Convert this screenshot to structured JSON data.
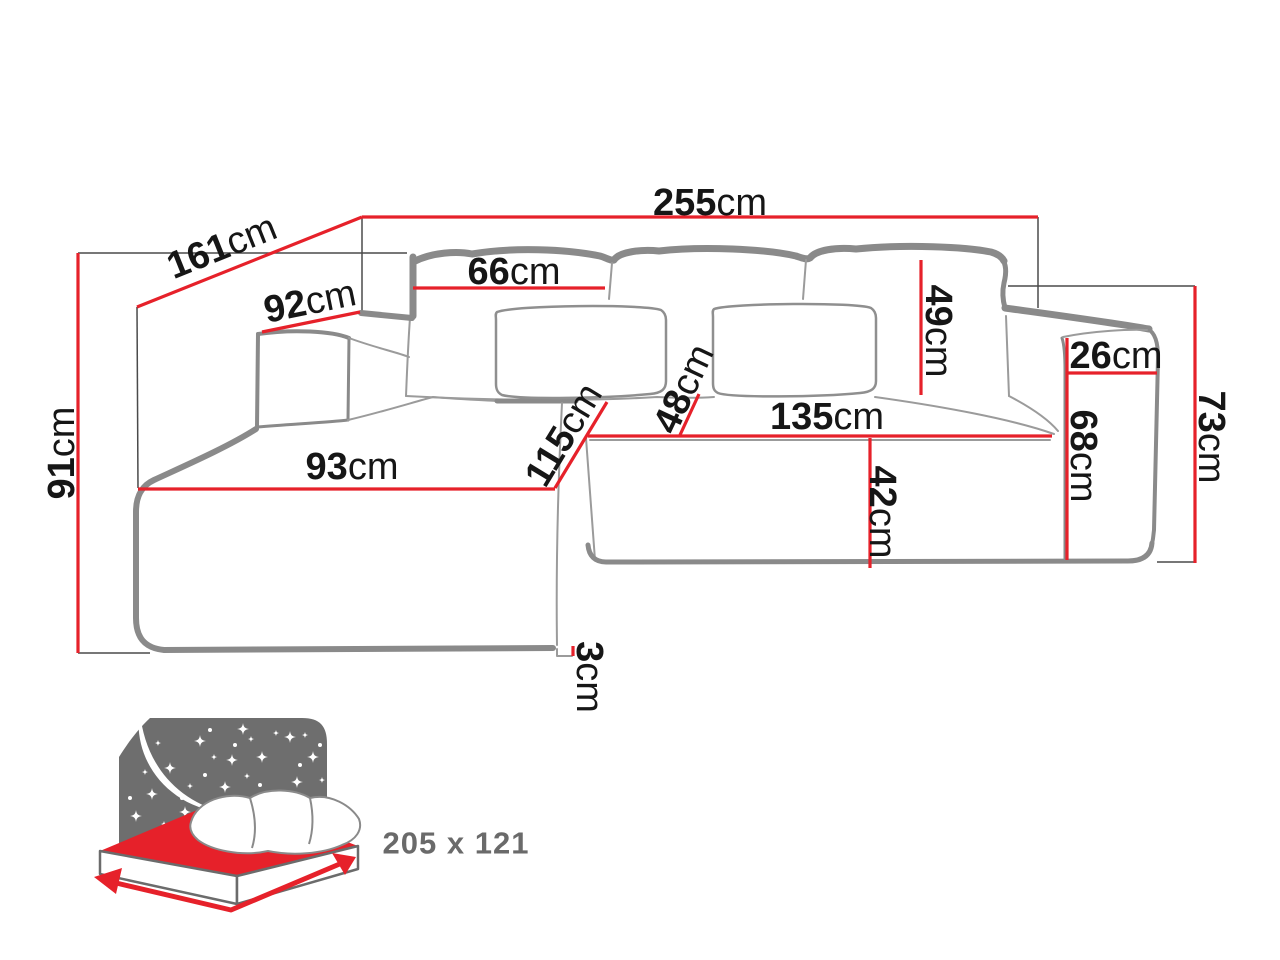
{
  "page": {
    "background": "#ffffff"
  },
  "dimensions": {
    "total_width": {
      "value": "255",
      "unit": "cm"
    },
    "chaise_side_depth": {
      "value": "161",
      "unit": "cm"
    },
    "left_armrest_top_depth": {
      "value": "92",
      "unit": "cm"
    },
    "total_height": {
      "value": "91",
      "unit": "cm"
    },
    "back_cushion_width": {
      "value": "66",
      "unit": "cm"
    },
    "back_cushion_height": {
      "value": "49",
      "unit": "cm"
    },
    "right_armrest_width": {
      "value": "26",
      "unit": "cm"
    },
    "right_side_height": {
      "value": "73",
      "unit": "cm"
    },
    "right_armrest_height": {
      "value": "68",
      "unit": "cm"
    },
    "seat_width": {
      "value": "135",
      "unit": "cm"
    },
    "seat_front_height": {
      "value": "42",
      "unit": "cm"
    },
    "chaise_width": {
      "value": "93",
      "unit": "cm"
    },
    "chaise_seat_depth": {
      "value": "115",
      "unit": "cm"
    },
    "seat_depth": {
      "value": "48",
      "unit": "cm"
    },
    "leg_height": {
      "value": "3",
      "unit": "cm"
    }
  },
  "sleeping_function": {
    "size_label": "205 x 121"
  },
  "colors": {
    "dimension_line": "#e6212a",
    "sofa_outline": "#8a8a8a",
    "seam_gray": "#9b9b9b",
    "extension_gray": "#4a4a4a",
    "label_text": "#161616",
    "icon_gray": "#6e6e6e",
    "icon_label_text": "#6a6a6a"
  }
}
